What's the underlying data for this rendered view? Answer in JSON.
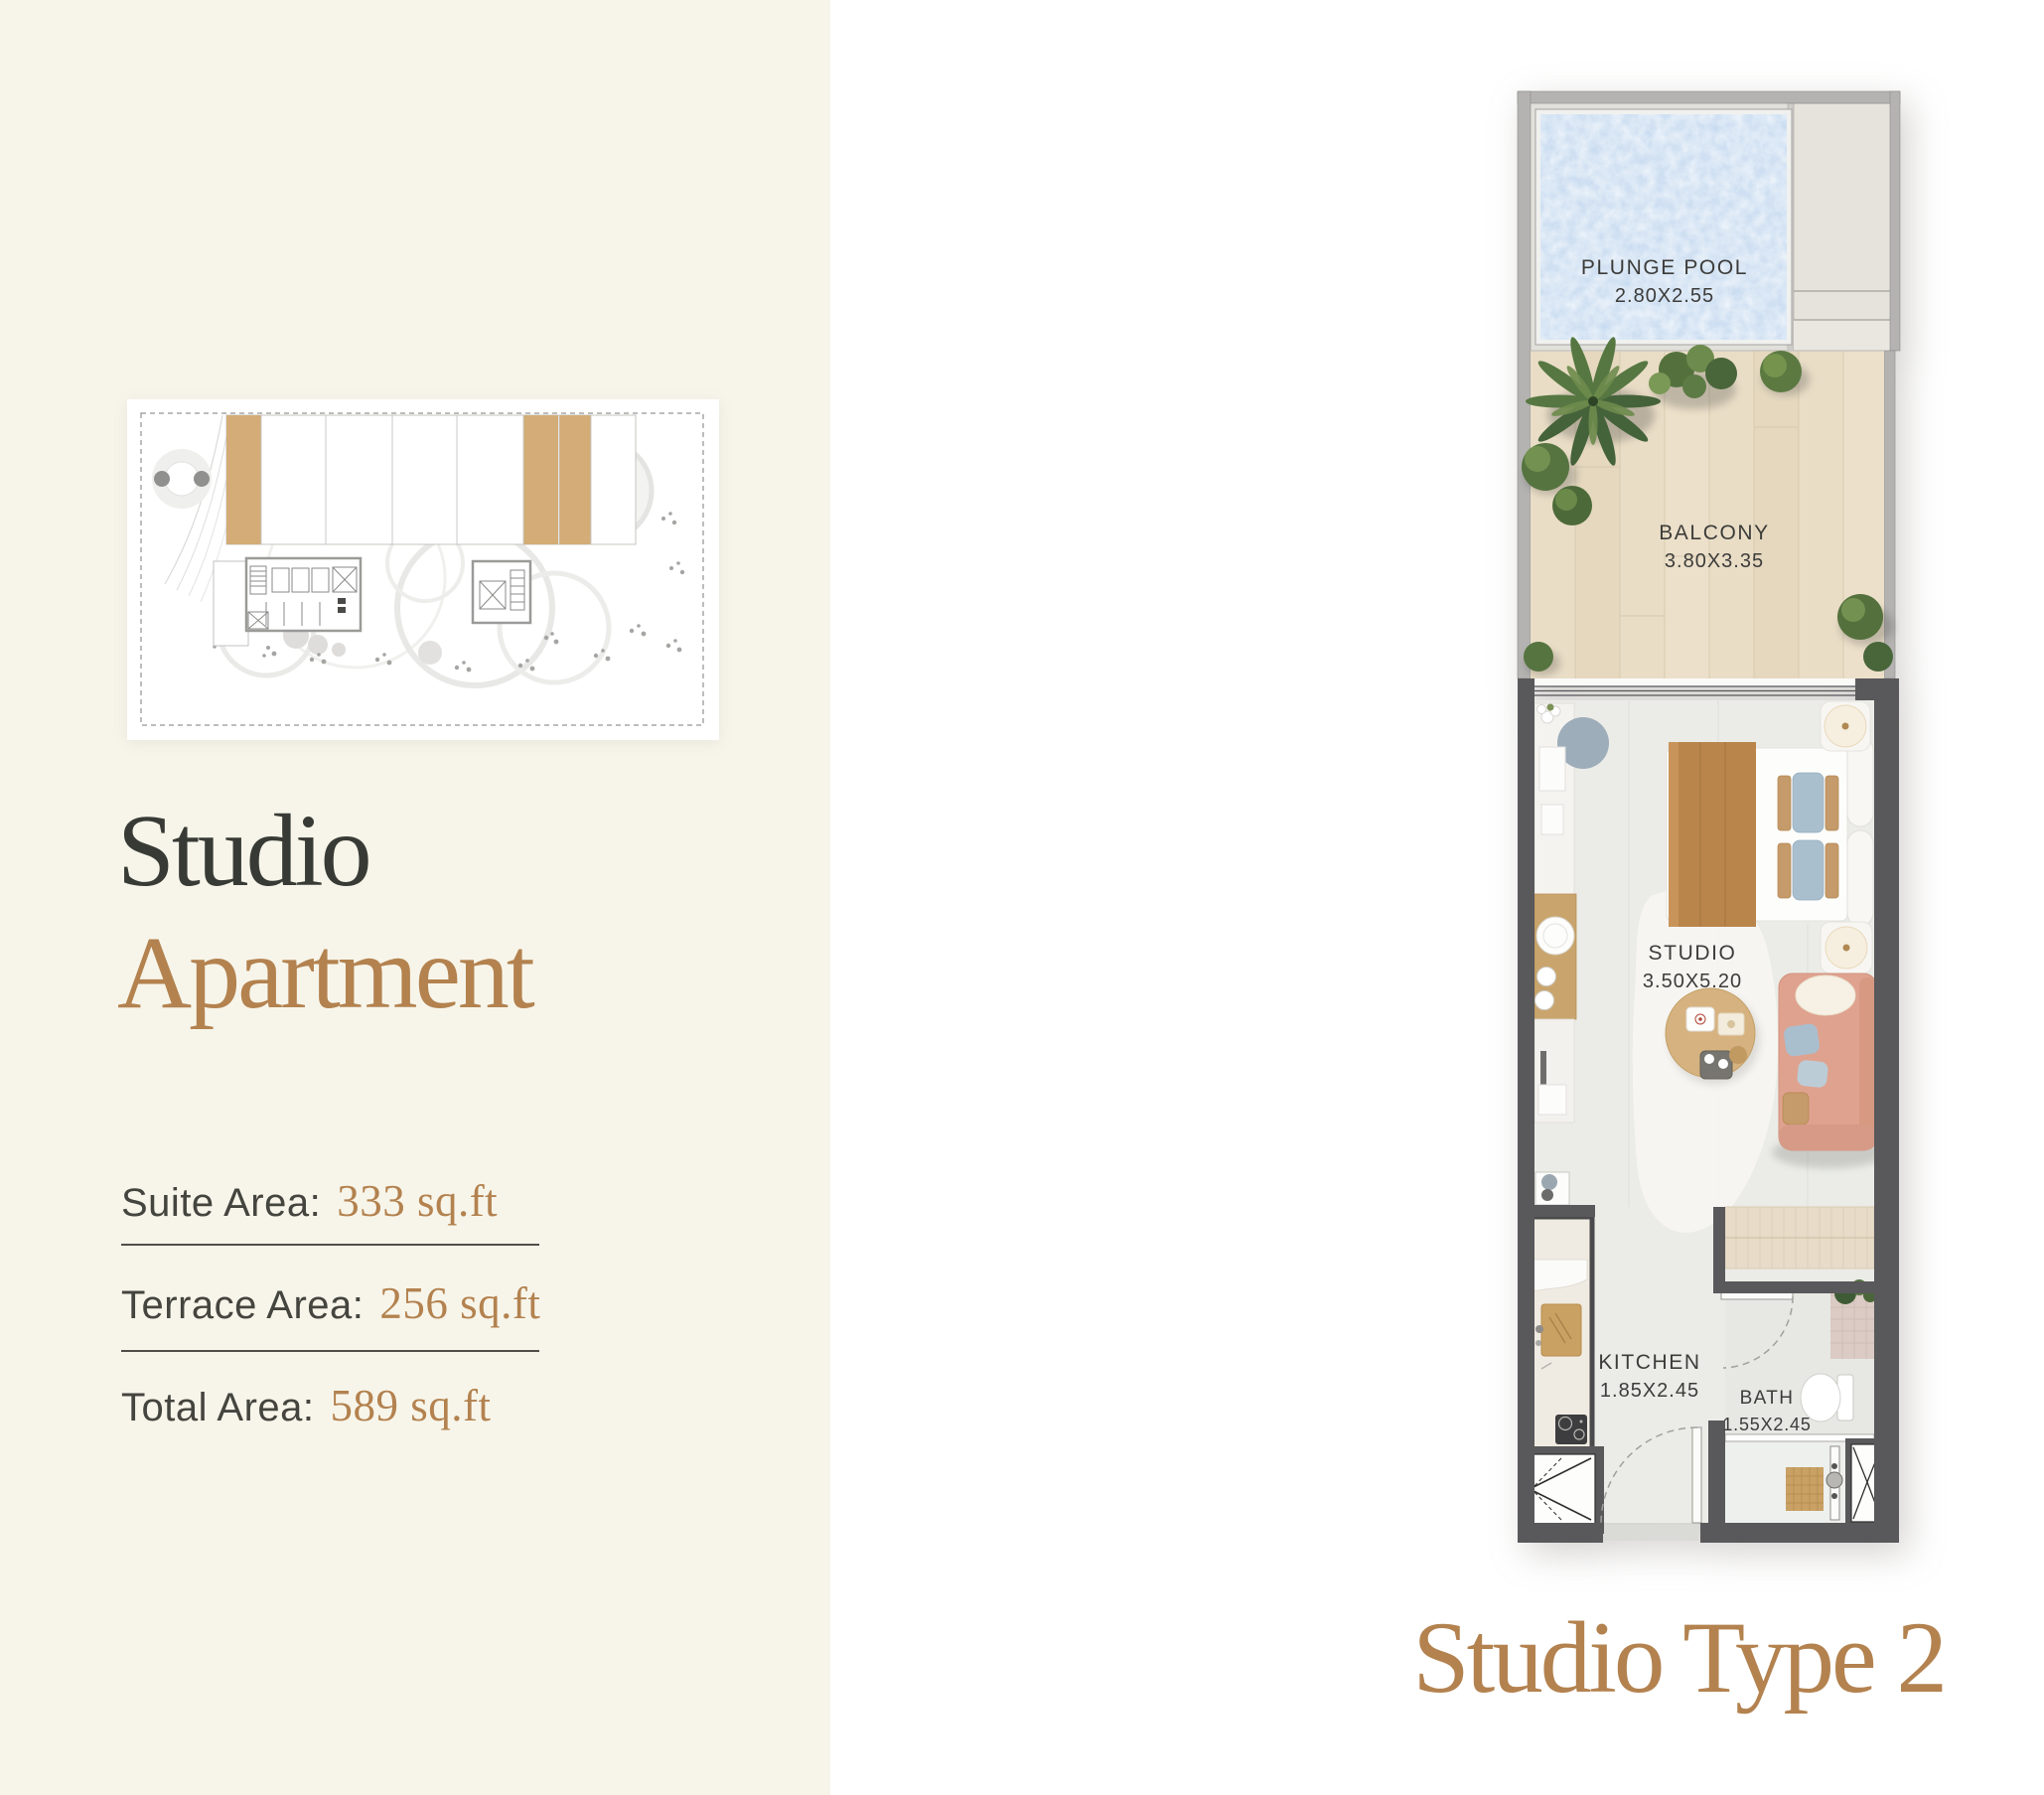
{
  "left_panel": {
    "unit_title": {
      "line1": "Studio",
      "line2": "Apartment"
    },
    "areas": [
      {
        "label": "Suite Area:",
        "value": "333 sq.ft"
      },
      {
        "label": "Terrace Area:",
        "value": "256 sq.ft"
      },
      {
        "label": "Total Area:",
        "value": "589 sq.ft"
      }
    ]
  },
  "floorplan": {
    "rooms": [
      {
        "name": "PLUNGE POOL",
        "dims": "2.80X2.55"
      },
      {
        "name": "BALCONY",
        "dims": "3.80X3.35"
      },
      {
        "name": "STUDIO",
        "dims": "3.50X5.20"
      },
      {
        "name": "KITCHEN",
        "dims": "1.85X2.45"
      },
      {
        "name": "BATH",
        "dims": "1.55X2.45"
      }
    ]
  },
  "plan_type_title": "Studio Type 2",
  "colors": {
    "cream_panel": "#f7f5ea",
    "accent_brown": "#b3824f",
    "title_ink": "#383b35",
    "wall_dark": "#59585b",
    "pool_blue": "#c3d8ef",
    "balcony_wood": "#e9ddc6",
    "site_plan_tan": "#d3ac77"
  }
}
